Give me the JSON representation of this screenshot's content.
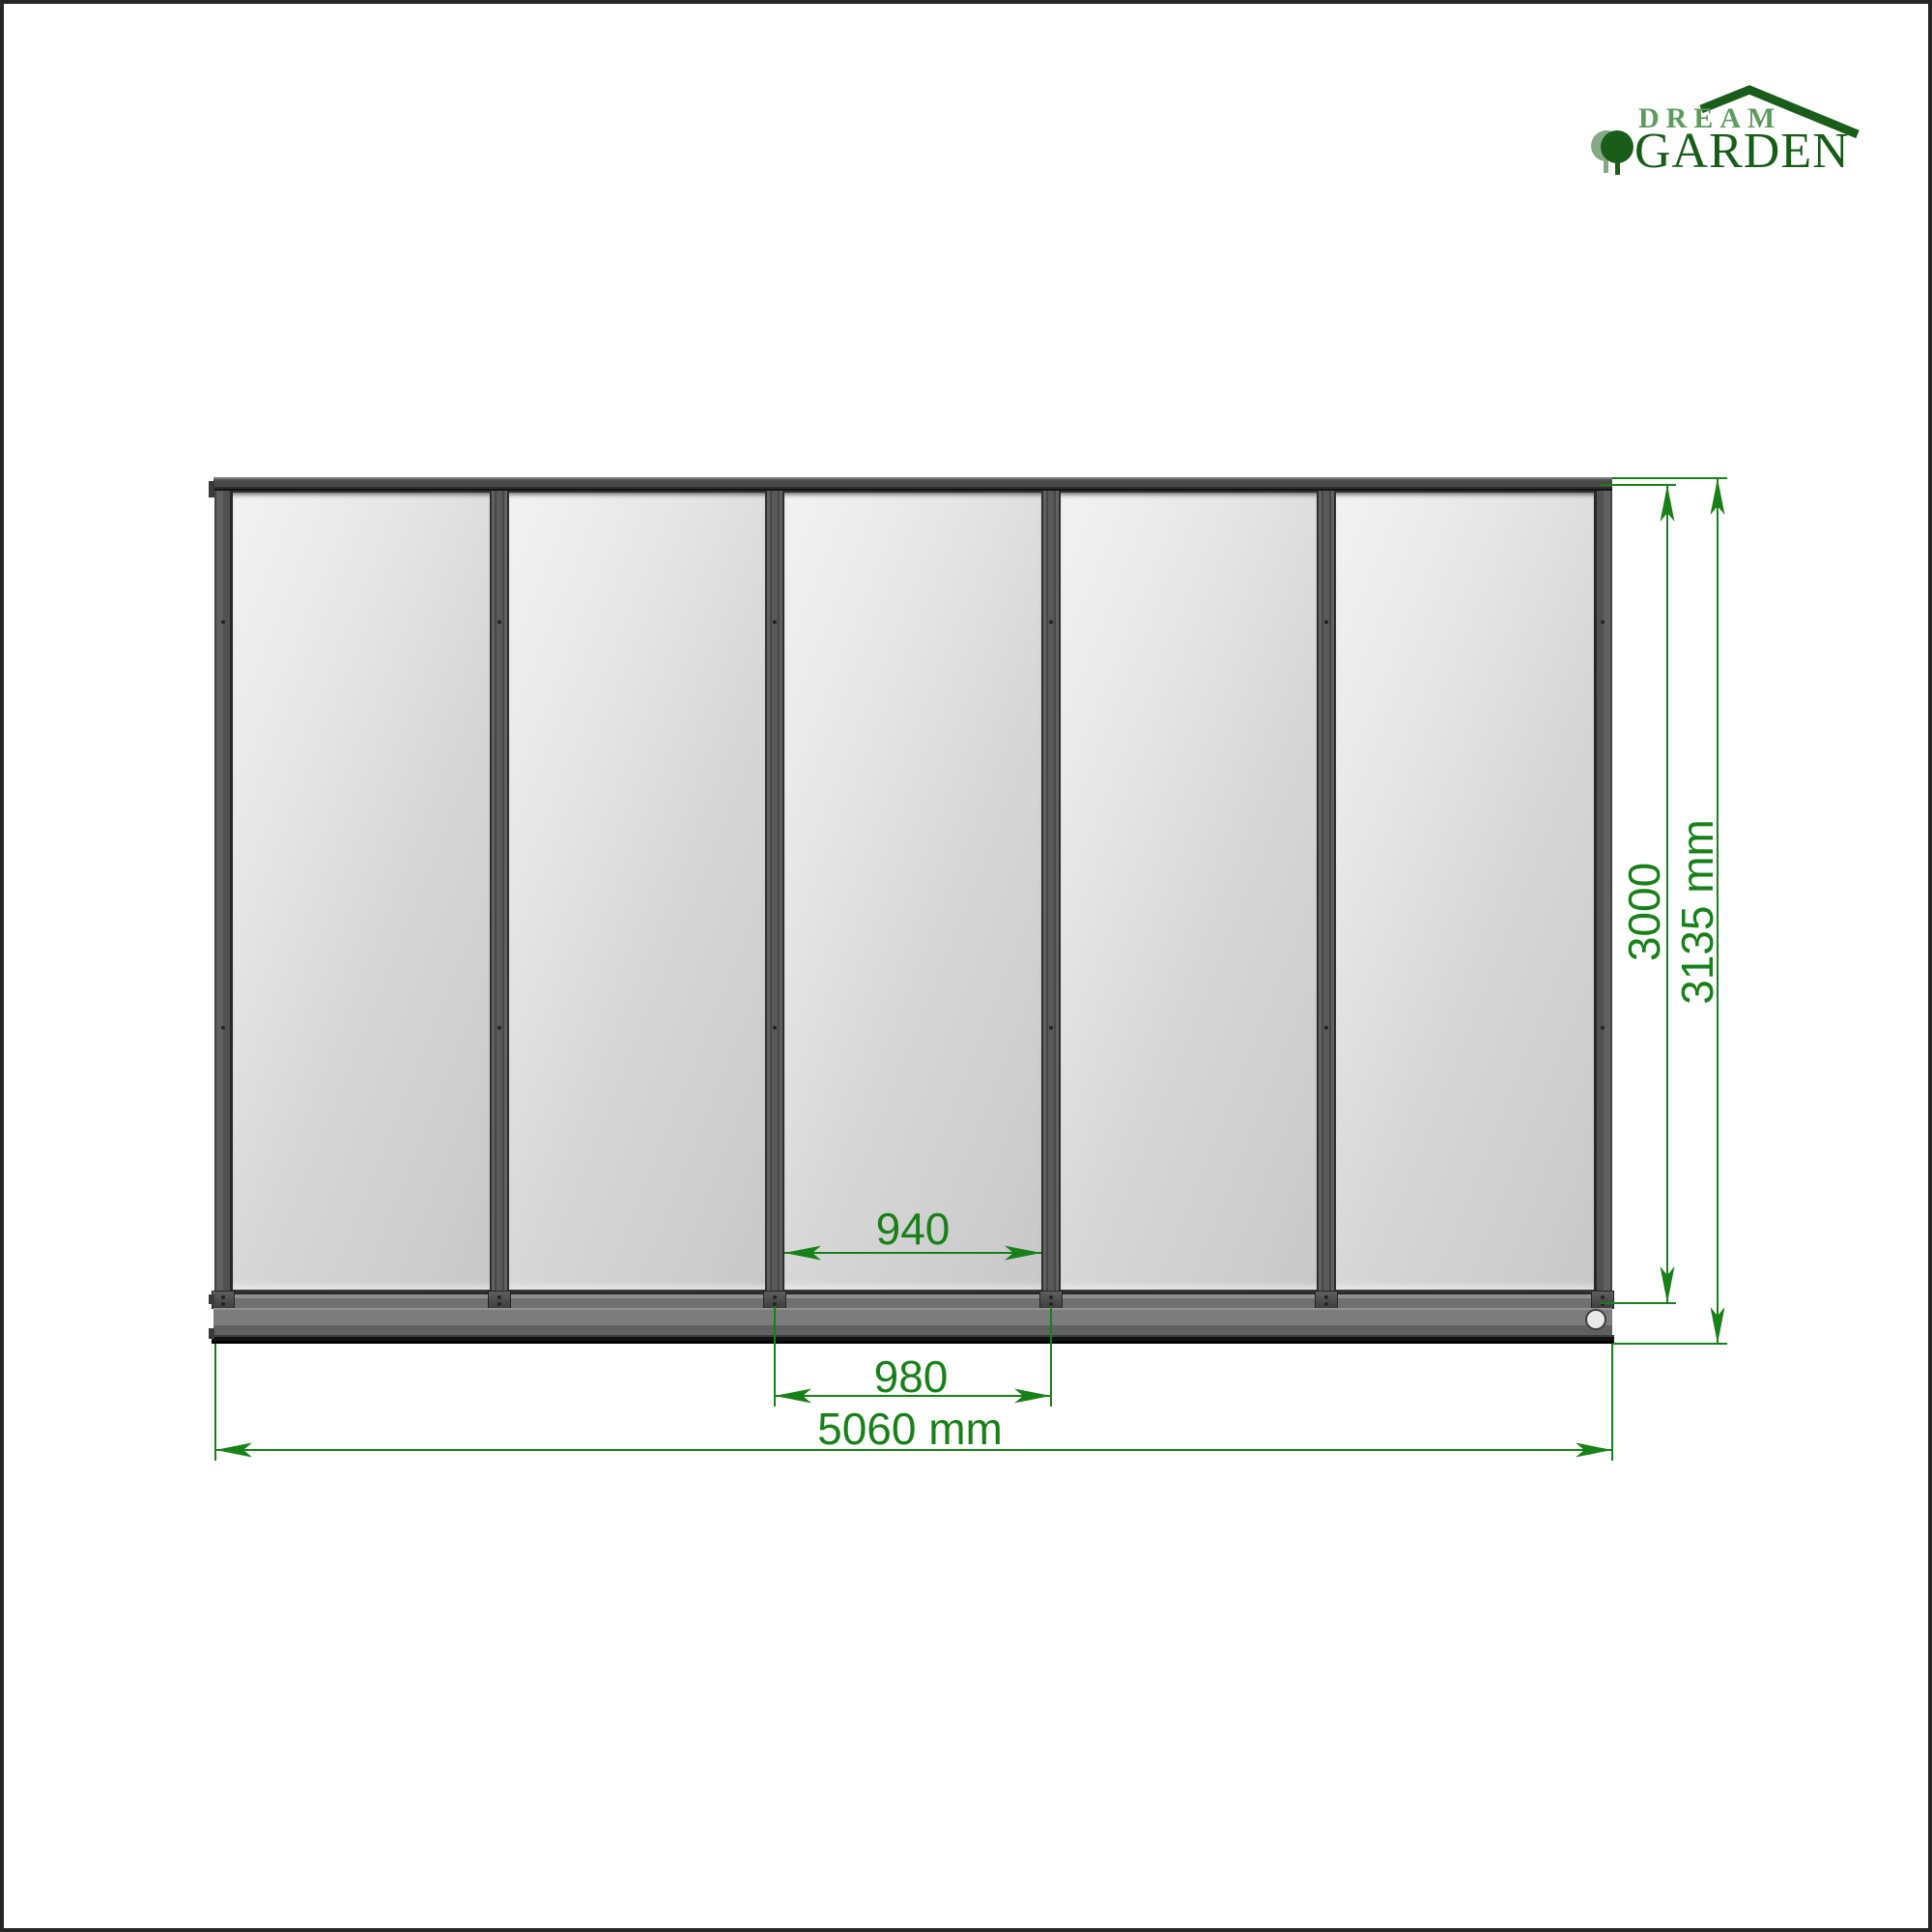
{
  "logo": {
    "brand_line1": "DREAM",
    "brand_line2": "GARDEN",
    "colors": {
      "light_green": "#5d9b5d",
      "dark_green": "#175c17",
      "tree_light": "#84a984"
    }
  },
  "drawing": {
    "panel_count": 5,
    "dimensions": {
      "opening_width": "940",
      "post_spacing": "980",
      "total_width": "5060 mm",
      "frame_height": "3000",
      "overall_height": "3135 mm"
    },
    "colors": {
      "dimension_green": "#188018",
      "frame_dark": "#4a4a4a",
      "frame_mid": "#595959",
      "base_gray": "#7c7c7c",
      "glass_light": "#f2f2f2",
      "glass_dark": "#c8c8c8",
      "page_border": "#262626"
    }
  }
}
